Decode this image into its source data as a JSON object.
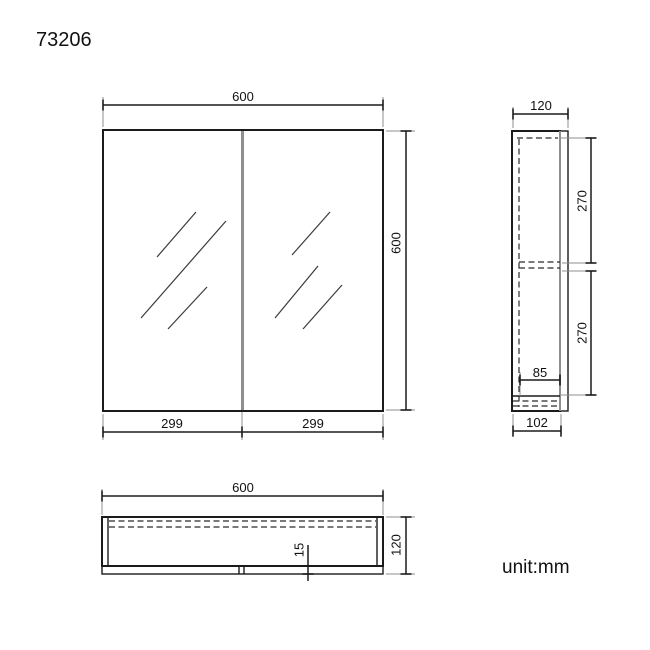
{
  "page": {
    "title": "73206",
    "unit_label": "unit:mm"
  },
  "front_view": {
    "overall_width_mm": "600",
    "overall_height_mm": "600",
    "left_door_width_mm": "299",
    "right_door_width_mm": "299"
  },
  "side_view": {
    "overall_depth_mm": "120",
    "upper_section_height_mm": "270",
    "lower_section_height_mm": "270",
    "interior_depth_mm": "85",
    "carcass_depth_mm": "102"
  },
  "bottom_view": {
    "overall_width_mm": "600",
    "overall_depth_mm": "120",
    "door_thickness_mm": "15"
  },
  "colors": {
    "line": "#1b1b1b",
    "extension_line": "#8f8f8f",
    "divider": "#8f8f8f",
    "background": "#ffffff"
  }
}
